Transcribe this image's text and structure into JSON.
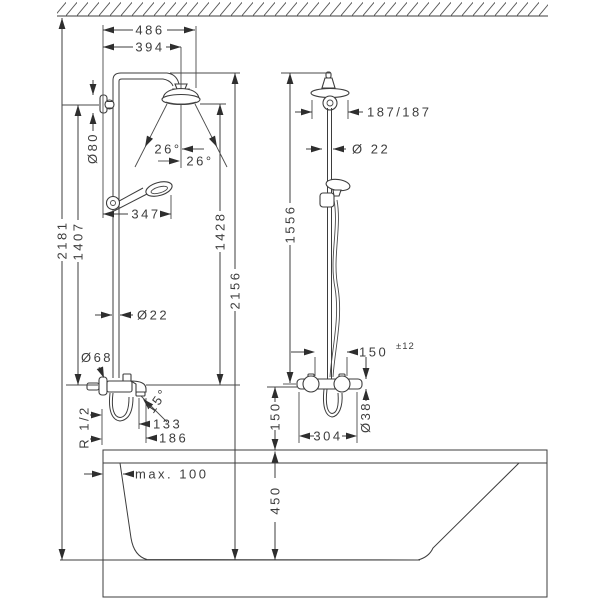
{
  "front_view": {
    "overall_width": "486",
    "head_center_width": "394",
    "total_height": "2181",
    "bracket_to_mixer_height": "1407",
    "bracket_diameter": "Ø80",
    "spray_angle_left": "26°",
    "spray_angle_right": "26°",
    "handshower_width": "347",
    "head_to_mixer_height": "1428",
    "pipe_top_to_floor_height": "2156",
    "pipe_diameter": "Ø22",
    "escutcheon_diameter": "Ø68",
    "connection_thread": "R 1/2",
    "spout_angle": "15°",
    "spout_reach": "133",
    "spout_reach_outer": "186"
  },
  "side_view": {
    "head_projection": "187/187",
    "pipe_diameter": "Ø 22",
    "pipe_height": "1556",
    "supply_connection_distance": "150",
    "supply_connection_tolerance": "±12",
    "valve_diameter": "Ø38",
    "valve_depth": "304",
    "rim_to_valve_height": "150"
  },
  "bathtub": {
    "max_wall_distance": "max. 100",
    "rim_height": "450"
  }
}
